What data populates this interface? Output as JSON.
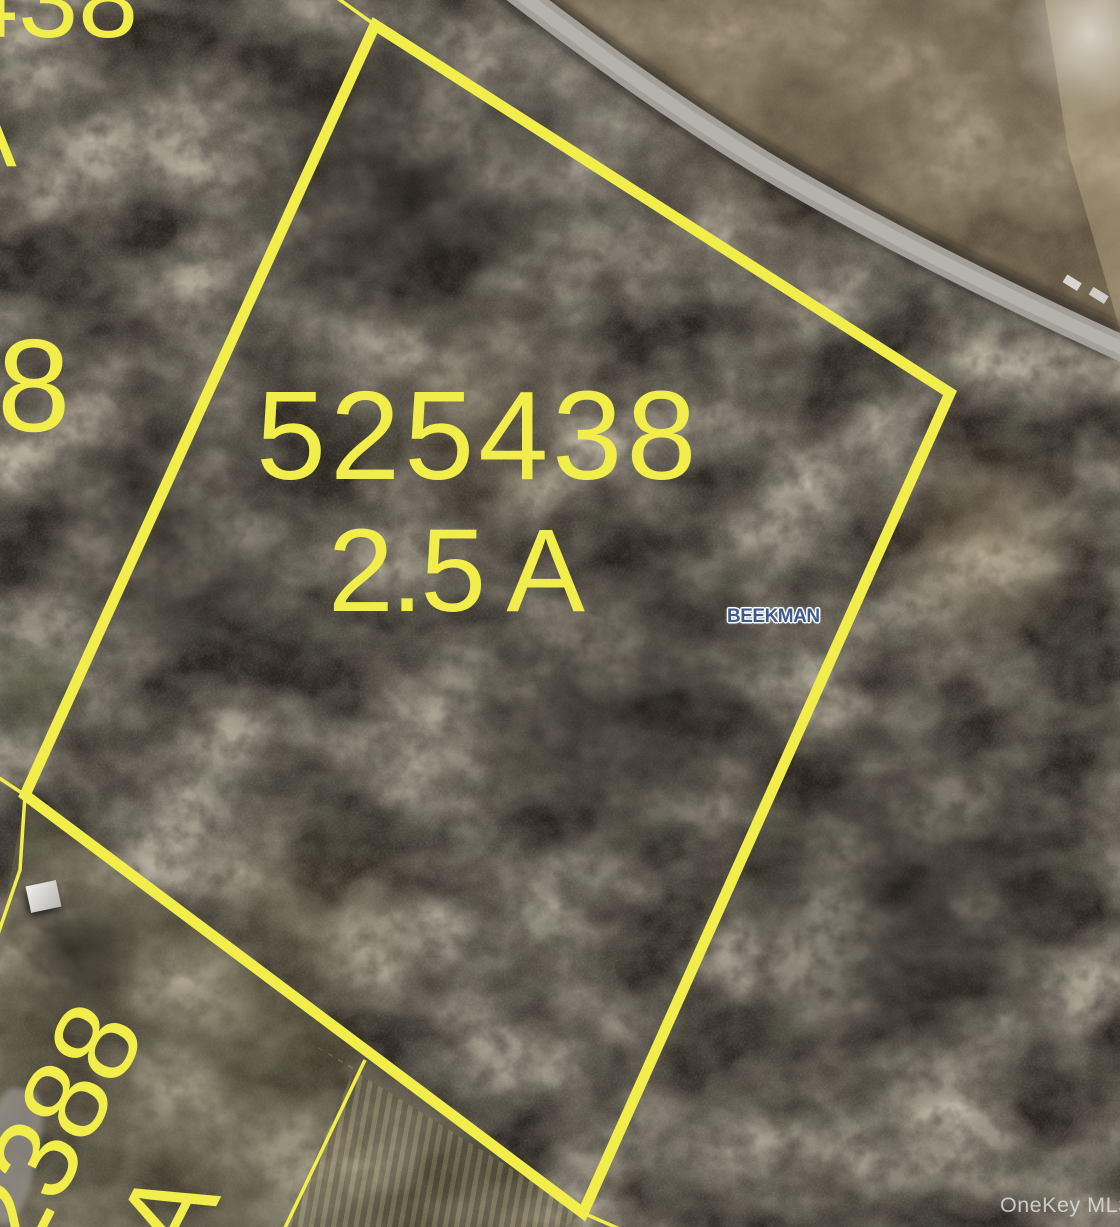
{
  "map": {
    "parcel": {
      "number": "525438",
      "acreage": "2.5 A",
      "municipality": "BEEKMAN"
    },
    "adjacent_parcels": {
      "top_partial_number": "438",
      "top_left_partial_acreage": "A",
      "left_partial_number": "8",
      "bottom_left_partial_number": "2388",
      "bottom_left_partial_acreage": "A"
    },
    "watermark": "OneKey MLS",
    "colors": {
      "boundary_yellow": "#F1EE4B",
      "municipality_blue": "#3A5A8F",
      "road_gray": "#A7A49B"
    }
  }
}
